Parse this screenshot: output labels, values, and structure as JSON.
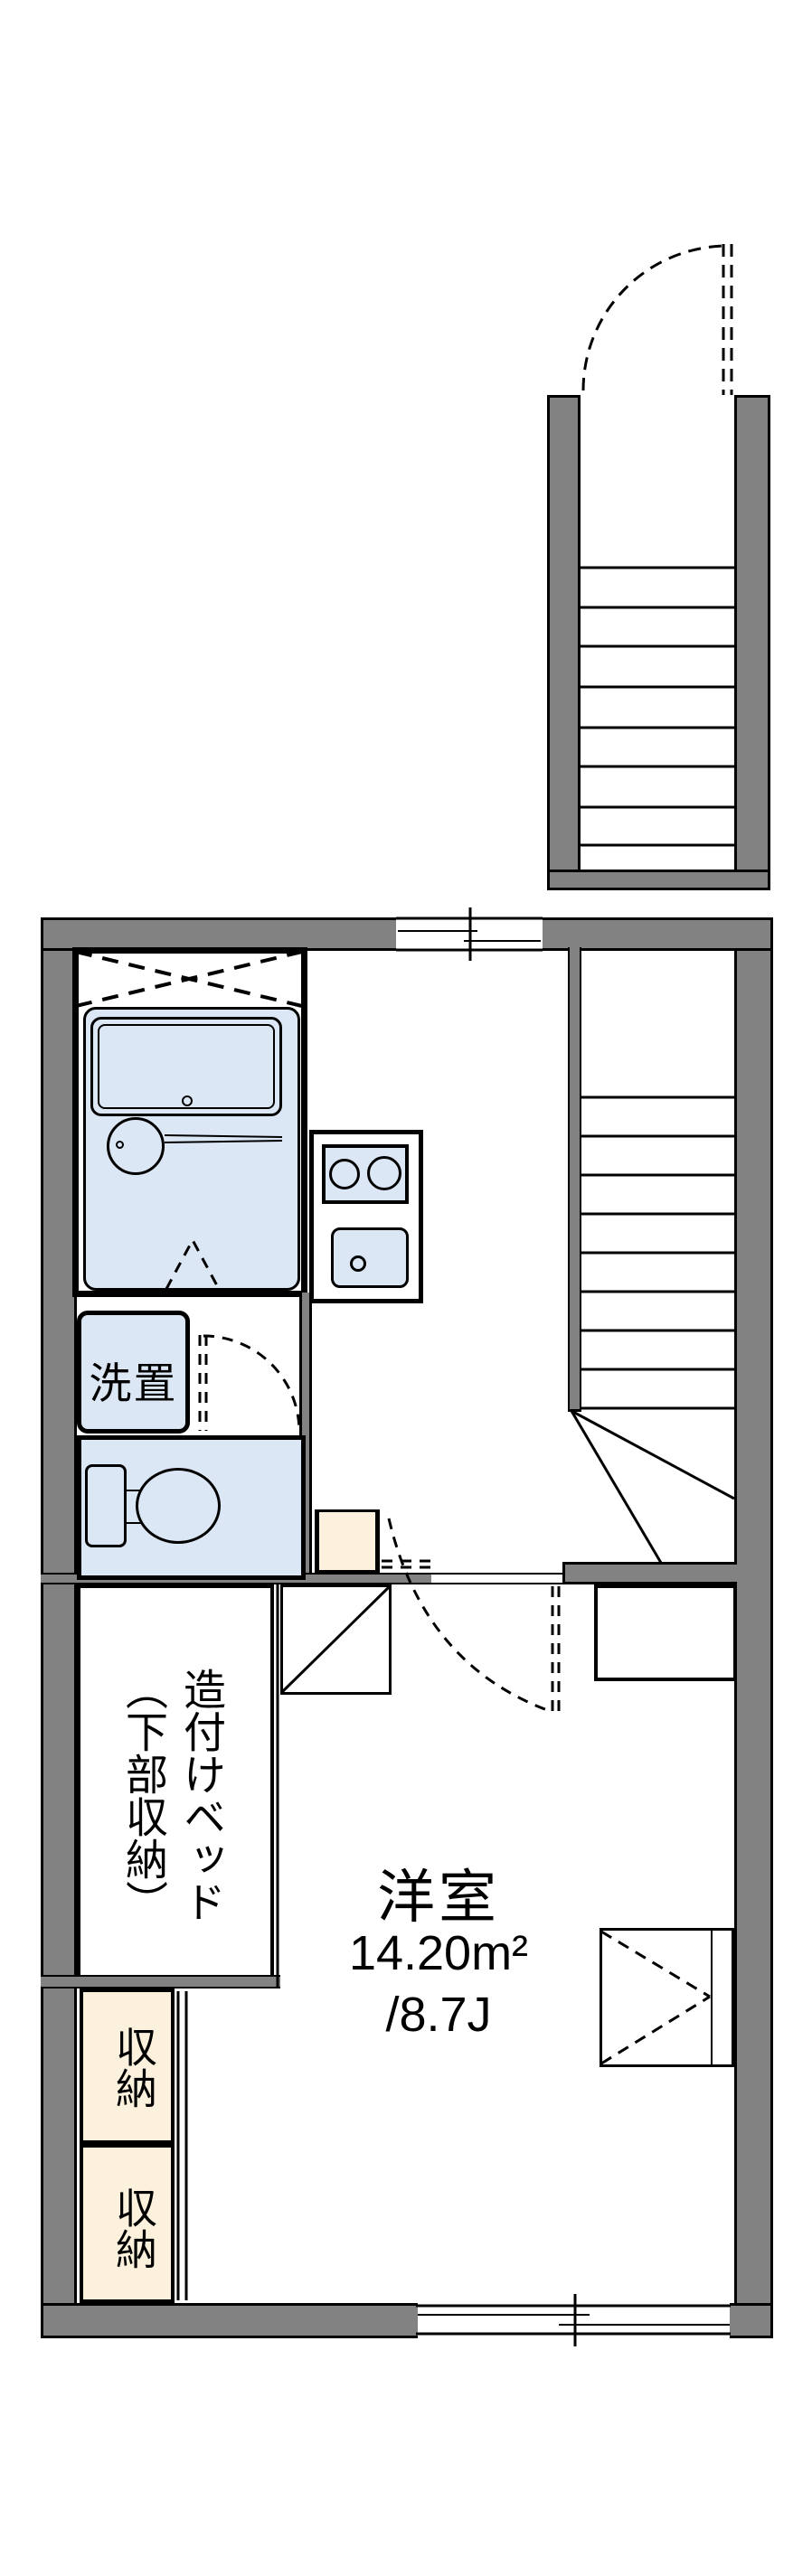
{
  "title": "floor-plan",
  "colors": {
    "wall": "#828282",
    "fixture": "#dce7f6",
    "storage": "#fbf1dc",
    "line": "#000000"
  },
  "labels": {
    "room": "洋室",
    "room_area_m2": "14.20m²",
    "room_area_tatami": "/8.7J",
    "washer": "洗置",
    "built_in_bed": "造付けベッド\n（下部収納）",
    "closet_upper": "収納",
    "closet_lower": "収納"
  }
}
